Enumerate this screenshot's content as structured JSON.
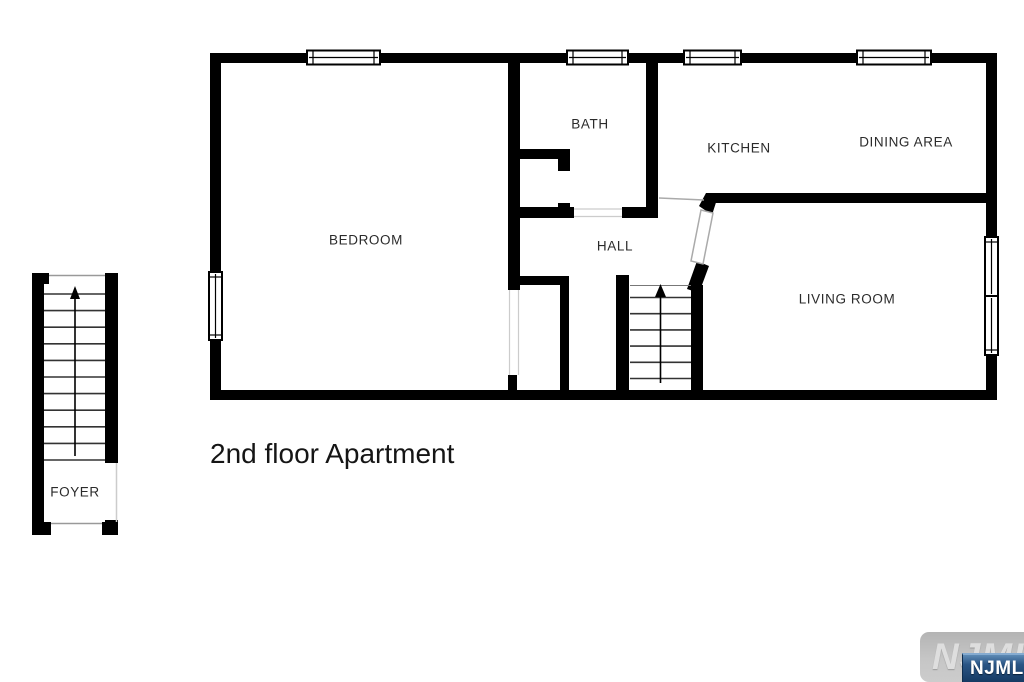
{
  "plan": {
    "title": "2nd floor Apartment",
    "rooms": [
      {
        "name": "bedroom",
        "label": "BEDROOM"
      },
      {
        "name": "bath",
        "label": "BATH"
      },
      {
        "name": "kitchen",
        "label": "KITCHEN"
      },
      {
        "name": "dining-area",
        "label": "DINING AREA"
      },
      {
        "name": "hall",
        "label": "HALL"
      },
      {
        "name": "living-room",
        "label": "LIVING ROOM"
      },
      {
        "name": "foyer",
        "label": "FOYER"
      }
    ],
    "stairs": [
      {
        "name": "hall-stairs",
        "direction": "up"
      },
      {
        "name": "foyer-stairs",
        "direction": "up"
      }
    ]
  },
  "watermark": {
    "background_text": "NJMLS",
    "badge_text": "NJMLS"
  },
  "colors": {
    "wall": "#000000",
    "background": "#ffffff",
    "label_text": "#2b2b2b",
    "badge_blue": "#1d4066",
    "watermark_gray": "#c2c2c2"
  }
}
